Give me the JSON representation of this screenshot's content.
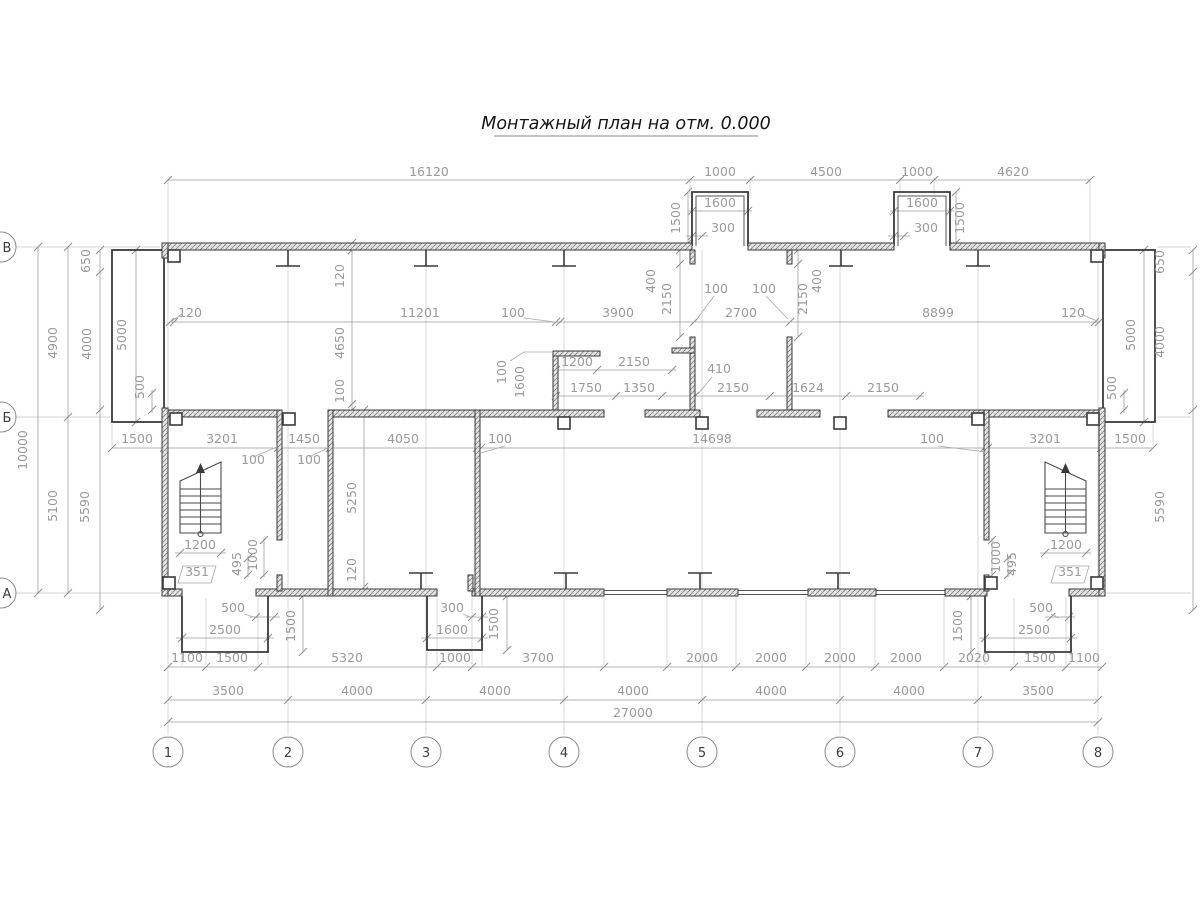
{
  "title": "Монтажный план на отм. 0.000",
  "axes": {
    "cols": [
      {
        "label": "1",
        "x": 168
      },
      {
        "label": "2",
        "x": 288
      },
      {
        "label": "3",
        "x": 426
      },
      {
        "label": "4",
        "x": 564
      },
      {
        "label": "5",
        "x": 702
      },
      {
        "label": "6",
        "x": 840
      },
      {
        "label": "7",
        "x": 978
      },
      {
        "label": "8",
        "x": 1098
      }
    ],
    "rows": [
      {
        "label": "В",
        "y": 247
      },
      {
        "label": "Б",
        "y": 417
      },
      {
        "label": "А",
        "y": 593
      }
    ],
    "col_spacings_mm": [
      "3500",
      "4000",
      "4000",
      "4000",
      "4000",
      "4000",
      "3500"
    ],
    "total_width_mm": "27000",
    "row_spacings_mm": [
      "4900",
      "5100"
    ],
    "total_height_mm": "10000"
  },
  "annotations": [
    {
      "t": "16120",
      "x": 429,
      "y": 176
    },
    {
      "t": "1000",
      "x": 720,
      "y": 176
    },
    {
      "t": "4500",
      "x": 826,
      "y": 176
    },
    {
      "t": "1000",
      "x": 917,
      "y": 176
    },
    {
      "t": "4620",
      "x": 1013,
      "y": 176
    },
    {
      "t": "1600",
      "x": 720,
      "y": 207
    },
    {
      "t": "300",
      "x": 723,
      "y": 232
    },
    {
      "t": "1500",
      "x": 680,
      "y": 218,
      "r": 1
    },
    {
      "t": "1600",
      "x": 922,
      "y": 207
    },
    {
      "t": "300",
      "x": 926,
      "y": 232
    },
    {
      "t": "1500",
      "x": 964,
      "y": 218,
      "r": 1
    },
    {
      "t": "120",
      "x": 190,
      "y": 317
    },
    {
      "t": "11201",
      "x": 420,
      "y": 317
    },
    {
      "t": "100",
      "x": 513,
      "y": 317
    },
    {
      "t": "3900",
      "x": 618,
      "y": 317
    },
    {
      "t": "2700",
      "x": 741,
      "y": 317
    },
    {
      "t": "8899",
      "x": 938,
      "y": 317
    },
    {
      "t": "120",
      "x": 1073,
      "y": 317
    },
    {
      "t": "100",
      "x": 716,
      "y": 293
    },
    {
      "t": "100",
      "x": 764,
      "y": 293
    },
    {
      "t": "2150",
      "x": 671,
      "y": 299,
      "r": 1
    },
    {
      "t": "400",
      "x": 655,
      "y": 281,
      "r": 1
    },
    {
      "t": "2150",
      "x": 807,
      "y": 299,
      "r": 1
    },
    {
      "t": "400",
      "x": 821,
      "y": 281,
      "r": 1
    },
    {
      "t": "120",
      "x": 344,
      "y": 276,
      "r": 1
    },
    {
      "t": "4650",
      "x": 344,
      "y": 343,
      "r": 1
    },
    {
      "t": "100",
      "x": 344,
      "y": 391,
      "r": 1
    },
    {
      "t": "100",
      "x": 506,
      "y": 372,
      "r": 1
    },
    {
      "t": "1600",
      "x": 524,
      "y": 382,
      "r": 1
    },
    {
      "t": "1200",
      "x": 577,
      "y": 366
    },
    {
      "t": "2150",
      "x": 634,
      "y": 366
    },
    {
      "t": "1750",
      "x": 586,
      "y": 392
    },
    {
      "t": "1350",
      "x": 639,
      "y": 392
    },
    {
      "t": "410",
      "x": 719,
      "y": 373
    },
    {
      "t": "2150",
      "x": 733,
      "y": 392
    },
    {
      "t": "1624",
      "x": 808,
      "y": 392
    },
    {
      "t": "2150",
      "x": 883,
      "y": 392
    },
    {
      "t": "1500",
      "x": 137,
      "y": 443
    },
    {
      "t": "3201",
      "x": 222,
      "y": 443
    },
    {
      "t": "1450",
      "x": 304,
      "y": 443
    },
    {
      "t": "4050",
      "x": 403,
      "y": 443
    },
    {
      "t": "100",
      "x": 500,
      "y": 443
    },
    {
      "t": "14698",
      "x": 712,
      "y": 443
    },
    {
      "t": "100",
      "x": 932,
      "y": 443
    },
    {
      "t": "3201",
      "x": 1045,
      "y": 443
    },
    {
      "t": "1500",
      "x": 1130,
      "y": 443
    },
    {
      "t": "100",
      "x": 253,
      "y": 464
    },
    {
      "t": "100",
      "x": 309,
      "y": 464
    },
    {
      "t": "5250",
      "x": 356,
      "y": 498,
      "r": 1
    },
    {
      "t": "120",
      "x": 356,
      "y": 570,
      "r": 1
    },
    {
      "t": "1200",
      "x": 200,
      "y": 549
    },
    {
      "t": "351",
      "x": 197,
      "y": 576
    },
    {
      "t": "495",
      "x": 241,
      "y": 564,
      "r": 1
    },
    {
      "t": "1000",
      "x": 257,
      "y": 555,
      "r": 1
    },
    {
      "t": "1200",
      "x": 1066,
      "y": 549
    },
    {
      "t": "351",
      "x": 1070,
      "y": 576
    },
    {
      "t": "1000",
      "x": 1000,
      "y": 557,
      "r": 1
    },
    {
      "t": "495",
      "x": 1016,
      "y": 564,
      "r": 1
    },
    {
      "t": "500",
      "x": 233,
      "y": 612
    },
    {
      "t": "2500",
      "x": 225,
      "y": 634
    },
    {
      "t": "1500",
      "x": 295,
      "y": 626,
      "r": 1
    },
    {
      "t": "300",
      "x": 452,
      "y": 612
    },
    {
      "t": "1600",
      "x": 452,
      "y": 634
    },
    {
      "t": "1500",
      "x": 498,
      "y": 624,
      "r": 1
    },
    {
      "t": "500",
      "x": 1041,
      "y": 612
    },
    {
      "t": "2500",
      "x": 1034,
      "y": 634
    },
    {
      "t": "1500",
      "x": 962,
      "y": 626,
      "r": 1
    },
    {
      "t": "1100",
      "x": 187,
      "y": 662
    },
    {
      "t": "1500",
      "x": 232,
      "y": 662
    },
    {
      "t": "5320",
      "x": 347,
      "y": 662
    },
    {
      "t": "1000",
      "x": 455,
      "y": 662
    },
    {
      "t": "3700",
      "x": 538,
      "y": 662
    },
    {
      "t": "2000",
      "x": 702,
      "y": 662
    },
    {
      "t": "2000",
      "x": 771,
      "y": 662
    },
    {
      "t": "2000",
      "x": 840,
      "y": 662
    },
    {
      "t": "2000",
      "x": 906,
      "y": 662
    },
    {
      "t": "2020",
      "x": 974,
      "y": 662
    },
    {
      "t": "1500",
      "x": 1040,
      "y": 662
    },
    {
      "t": "1100",
      "x": 1084,
      "y": 662
    },
    {
      "t": "3500",
      "x": 228,
      "y": 695
    },
    {
      "t": "4000",
      "x": 357,
      "y": 695
    },
    {
      "t": "4000",
      "x": 495,
      "y": 695
    },
    {
      "t": "4000",
      "x": 633,
      "y": 695
    },
    {
      "t": "4000",
      "x": 771,
      "y": 695
    },
    {
      "t": "4000",
      "x": 909,
      "y": 695
    },
    {
      "t": "3500",
      "x": 1038,
      "y": 695
    },
    {
      "t": "27000",
      "x": 633,
      "y": 717
    },
    {
      "t": "10000",
      "x": 27,
      "y": 450,
      "r": 1
    },
    {
      "t": "4900",
      "x": 57,
      "y": 343,
      "r": 1
    },
    {
      "t": "5100",
      "x": 57,
      "y": 506,
      "r": 1
    },
    {
      "t": "650",
      "x": 90,
      "y": 261,
      "r": 1
    },
    {
      "t": "4000",
      "x": 91,
      "y": 344,
      "r": 1
    },
    {
      "t": "500",
      "x": 144,
      "y": 387,
      "r": 1
    },
    {
      "t": "5000",
      "x": 126,
      "y": 335,
      "r": 1
    },
    {
      "t": "5590",
      "x": 89,
      "y": 507,
      "r": 1
    },
    {
      "t": "650",
      "x": 1164,
      "y": 262,
      "r": 1
    },
    {
      "t": "4000",
      "x": 1164,
      "y": 342,
      "r": 1
    },
    {
      "t": "5590",
      "x": 1164,
      "y": 507,
      "r": 1
    },
    {
      "t": "5000",
      "x": 1135,
      "y": 335,
      "r": 1
    },
    {
      "t": "500",
      "x": 1116,
      "y": 388,
      "r": 1
    }
  ]
}
